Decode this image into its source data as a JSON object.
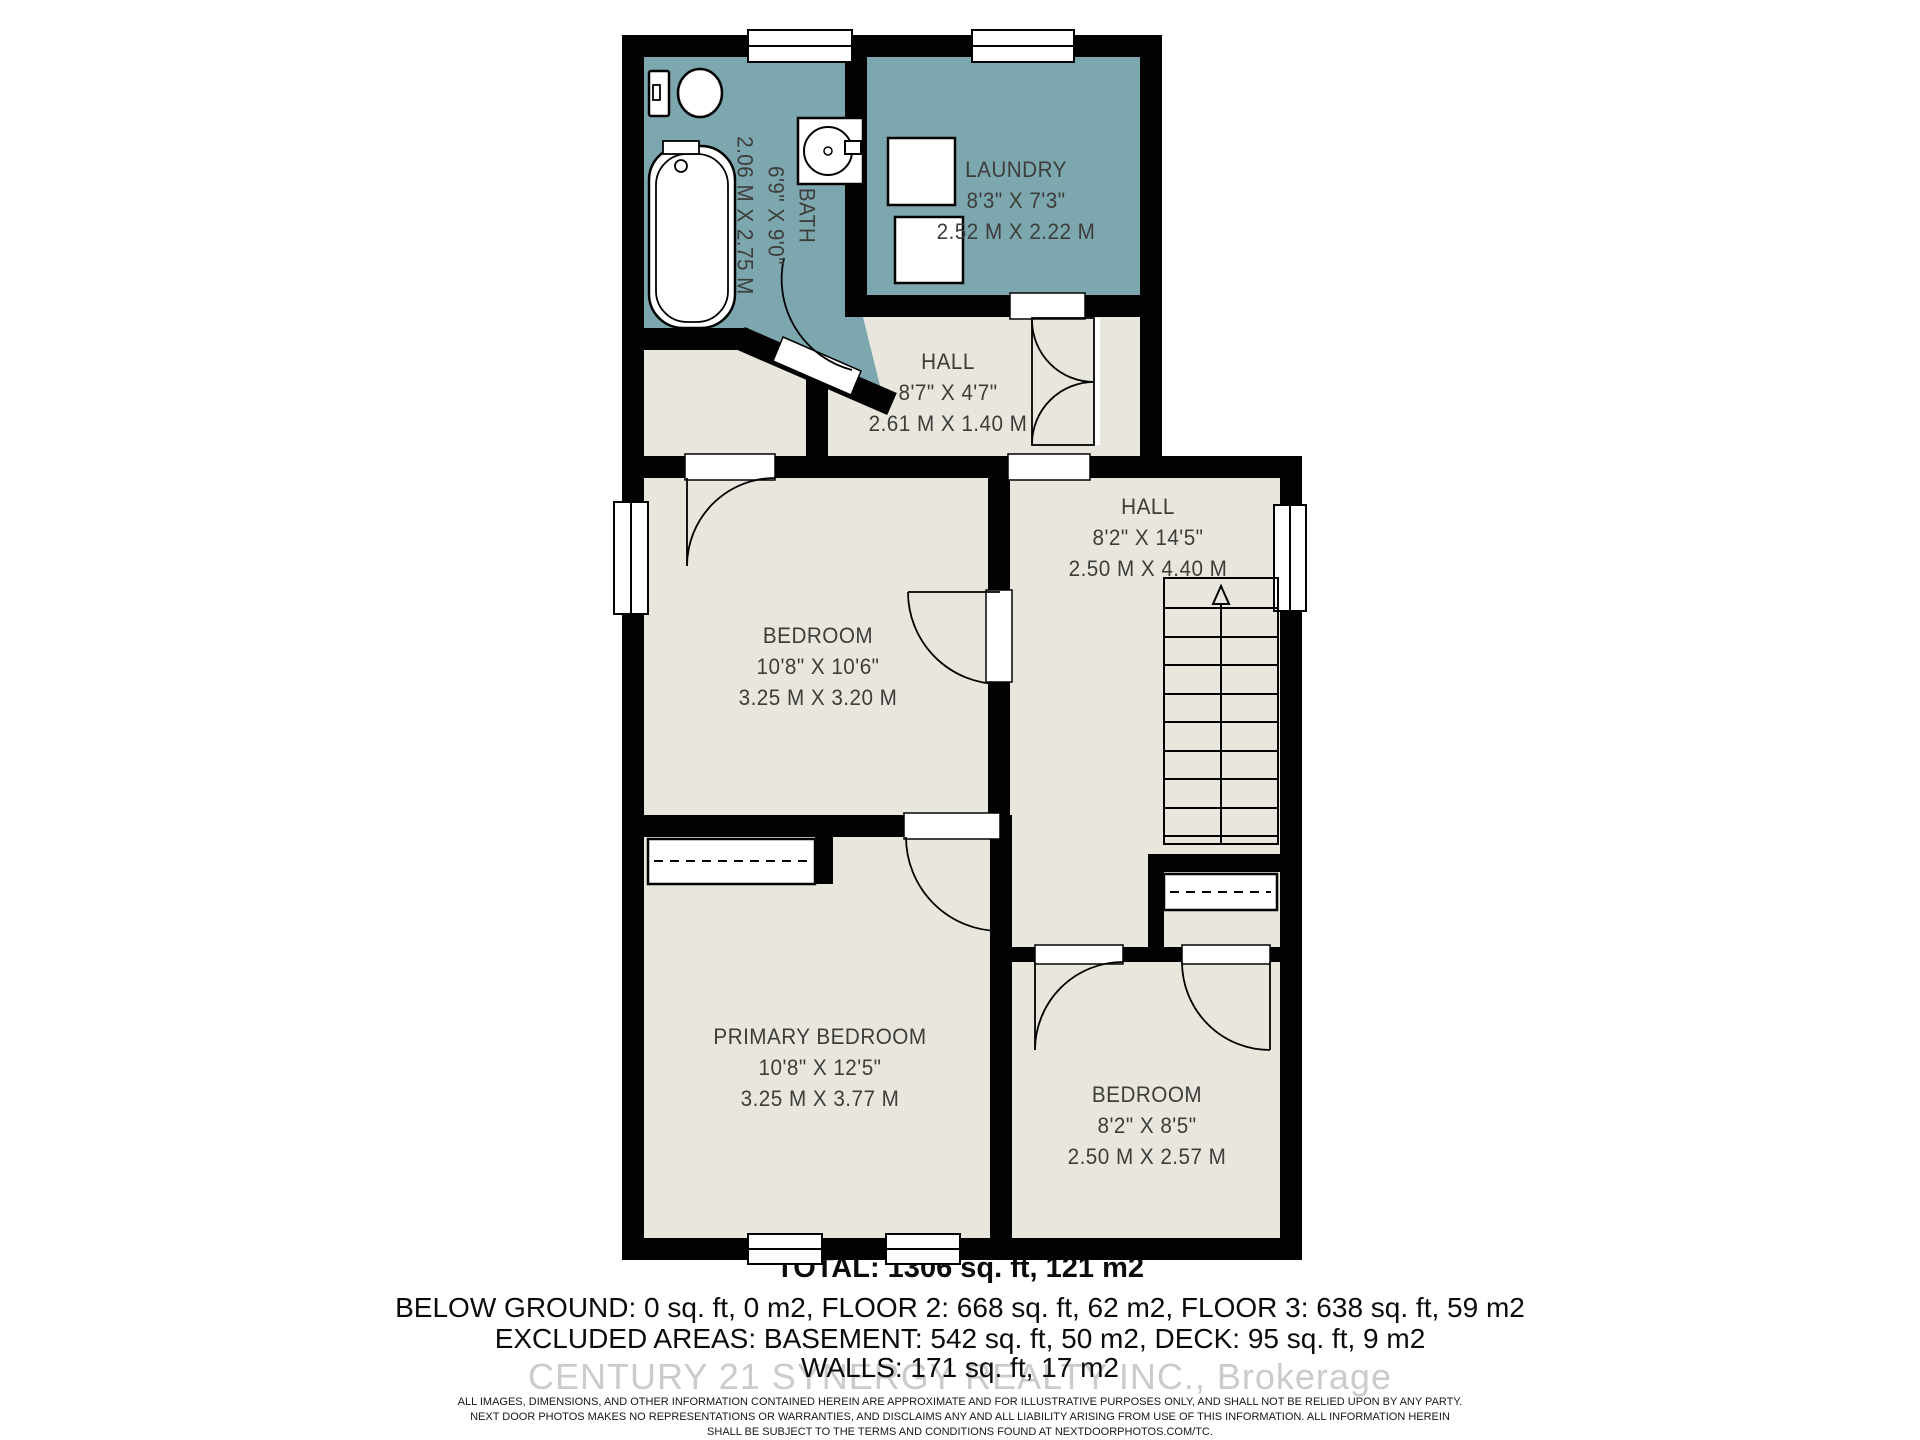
{
  "colors": {
    "room_teal": "#7ca7ae",
    "room_beige": "#e9e7dd",
    "wall_black": "#020202",
    "label_text": "#3d3d3b",
    "watermark_gray": "#cbcbcb"
  },
  "rooms": {
    "bath": {
      "name": "BATH",
      "imperial": "6'9\" X 9'0\"",
      "metric": "2.06 M X 2.75 M"
    },
    "laundry": {
      "name": "LAUNDRY",
      "imperial": "8'3\" X 7'3\"",
      "metric": "2.52 M X 2.22 M"
    },
    "hall_upper": {
      "name": "HALL",
      "imperial": "8'7\" X 4'7\"",
      "metric": "2.61 M X 1.40 M"
    },
    "hall_stairs": {
      "name": "HALL",
      "imperial": "8'2\" X 14'5\"",
      "metric": "2.50 M X 4.40 M"
    },
    "bedroom_middle": {
      "name": "BEDROOM",
      "imperial": "10'8\" X 10'6\"",
      "metric": "3.25 M X 3.20 M"
    },
    "primary_bedroom": {
      "name": "PRIMARY BEDROOM",
      "imperial": "10'8\" X 12'5\"",
      "metric": "3.25 M X 3.77 M"
    },
    "bedroom_lower": {
      "name": "BEDROOM",
      "imperial": "8'2\" X 8'5\"",
      "metric": "2.50 M X 2.57 M"
    }
  },
  "summary": {
    "total": "TOTAL: 1306 sq. ft, 121 m2",
    "line2": "BELOW GROUND: 0 sq. ft, 0 m2, FLOOR 2: 668 sq. ft, 62 m2, FLOOR 3: 638 sq. ft, 59 m2",
    "line3": "EXCLUDED AREAS: BASEMENT: 542 sq. ft, 50 m2, DECK: 95 sq. ft, 9 m2",
    "line4": "WALLS: 171 sq. ft, 17 m2"
  },
  "watermark": "CENTURY 21 SYNERGY REALTY INC., Brokerage",
  "disclaimer": {
    "line1": "ALL IMAGES, DIMENSIONS, AND OTHER INFORMATION CONTAINED HEREIN ARE APPROXIMATE AND FOR ILLUSTRATIVE PURPOSES ONLY, AND SHALL NOT BE RELIED UPON BY ANY PARTY.",
    "line2": "NEXT DOOR PHOTOS MAKES NO REPRESENTATIONS OR WARRANTIES, AND DISCLAIMS ANY AND ALL LIABILITY ARISING FROM USE OF THIS INFORMATION. ALL INFORMATION HEREIN",
    "line3": "SHALL BE SUBJECT TO THE TERMS AND CONDITIONS FOUND AT NEXTDOORPHOTOS.COM/TC."
  }
}
